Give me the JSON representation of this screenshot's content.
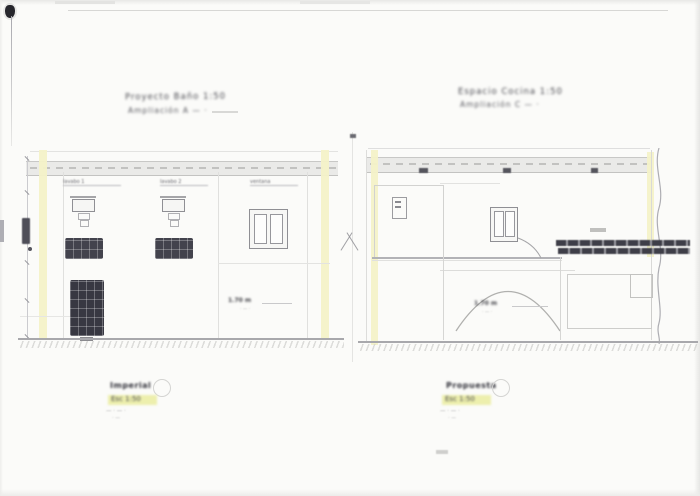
{
  "sheet": {
    "colors": {
      "paper": "#fbfbf9",
      "line_gray": "#bcbcc0",
      "wall_highlight_yellow": "#f4f2c8",
      "label_highlight_yellow": "#edefad",
      "fixture_ink_dark": "#43434d"
    }
  },
  "panels": {
    "left": {
      "title_line1": "Proyecto  Baño  1:50",
      "title_line2": "Ampliación  A — ·",
      "fixture_labels": [
        "lavabo 1",
        "lavabo 2",
        "ventana"
      ],
      "annotation": "1.70 m",
      "annotation_sub": "· — ·",
      "footer": {
        "name": "Imperial",
        "scale": "Esc 1:50",
        "note1": "— · — ·",
        "note2": "· —"
      }
    },
    "right": {
      "title_line1": "Espacio  Cocina  1:50",
      "title_line2": "Ampliación  C — ·",
      "annotation": "1.70 m",
      "annotation_sub": "· — ·",
      "footer": {
        "name": "Propuesta",
        "scale": "Esc 1:50",
        "note1": "— · — ·",
        "note2": "· —"
      }
    }
  }
}
